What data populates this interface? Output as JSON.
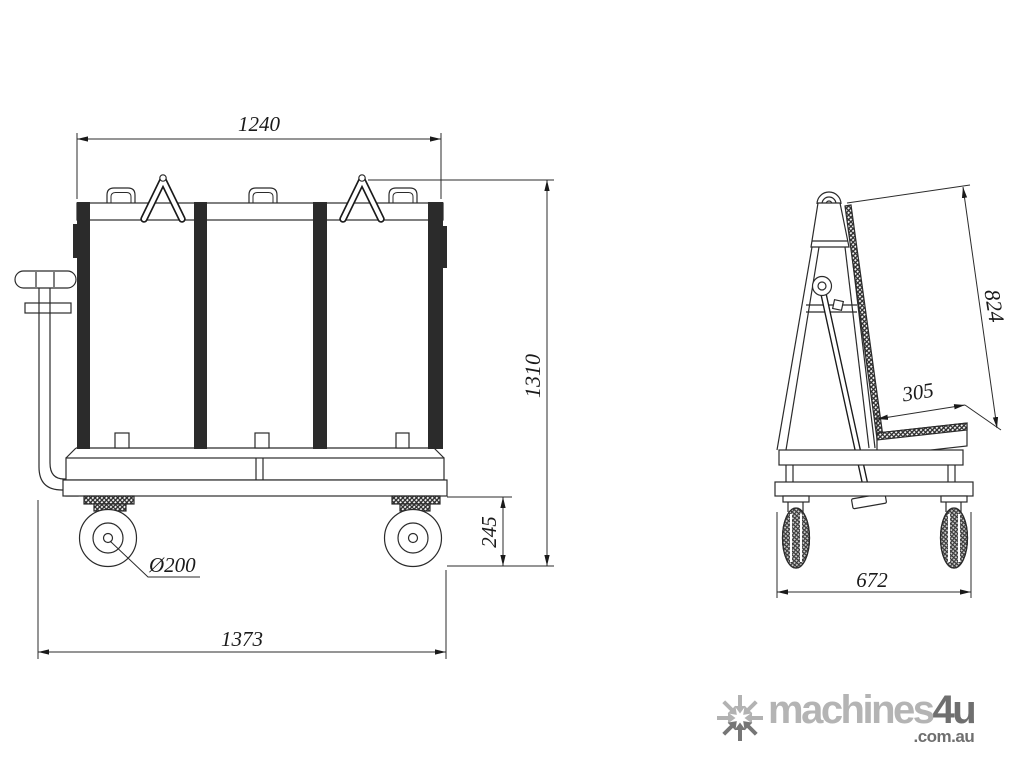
{
  "drawing": {
    "title_semantic": "A-frame glass transport trolley technical drawing",
    "front_view": {
      "dim_body_width": "1240",
      "dim_overall_height": "1310",
      "dim_caster_height": "245",
      "dim_overall_length": "1373",
      "dim_wheel_diameter": "Ø200"
    },
    "side_view": {
      "dim_backrest_length": "824",
      "dim_shelf_depth": "305",
      "dim_overall_width": "672"
    },
    "colors": {
      "line": "#2b2b2b",
      "post_fill": "#1c1c1c",
      "brand_light": "#b4b4b4",
      "brand_dark": "#6f6f6f"
    },
    "icons": {
      "logo_mark": "converging-arrows-star-icon"
    }
  },
  "watermark": {
    "brand_main": "machines",
    "brand_accent": "4u",
    "domain": ".com.au"
  }
}
